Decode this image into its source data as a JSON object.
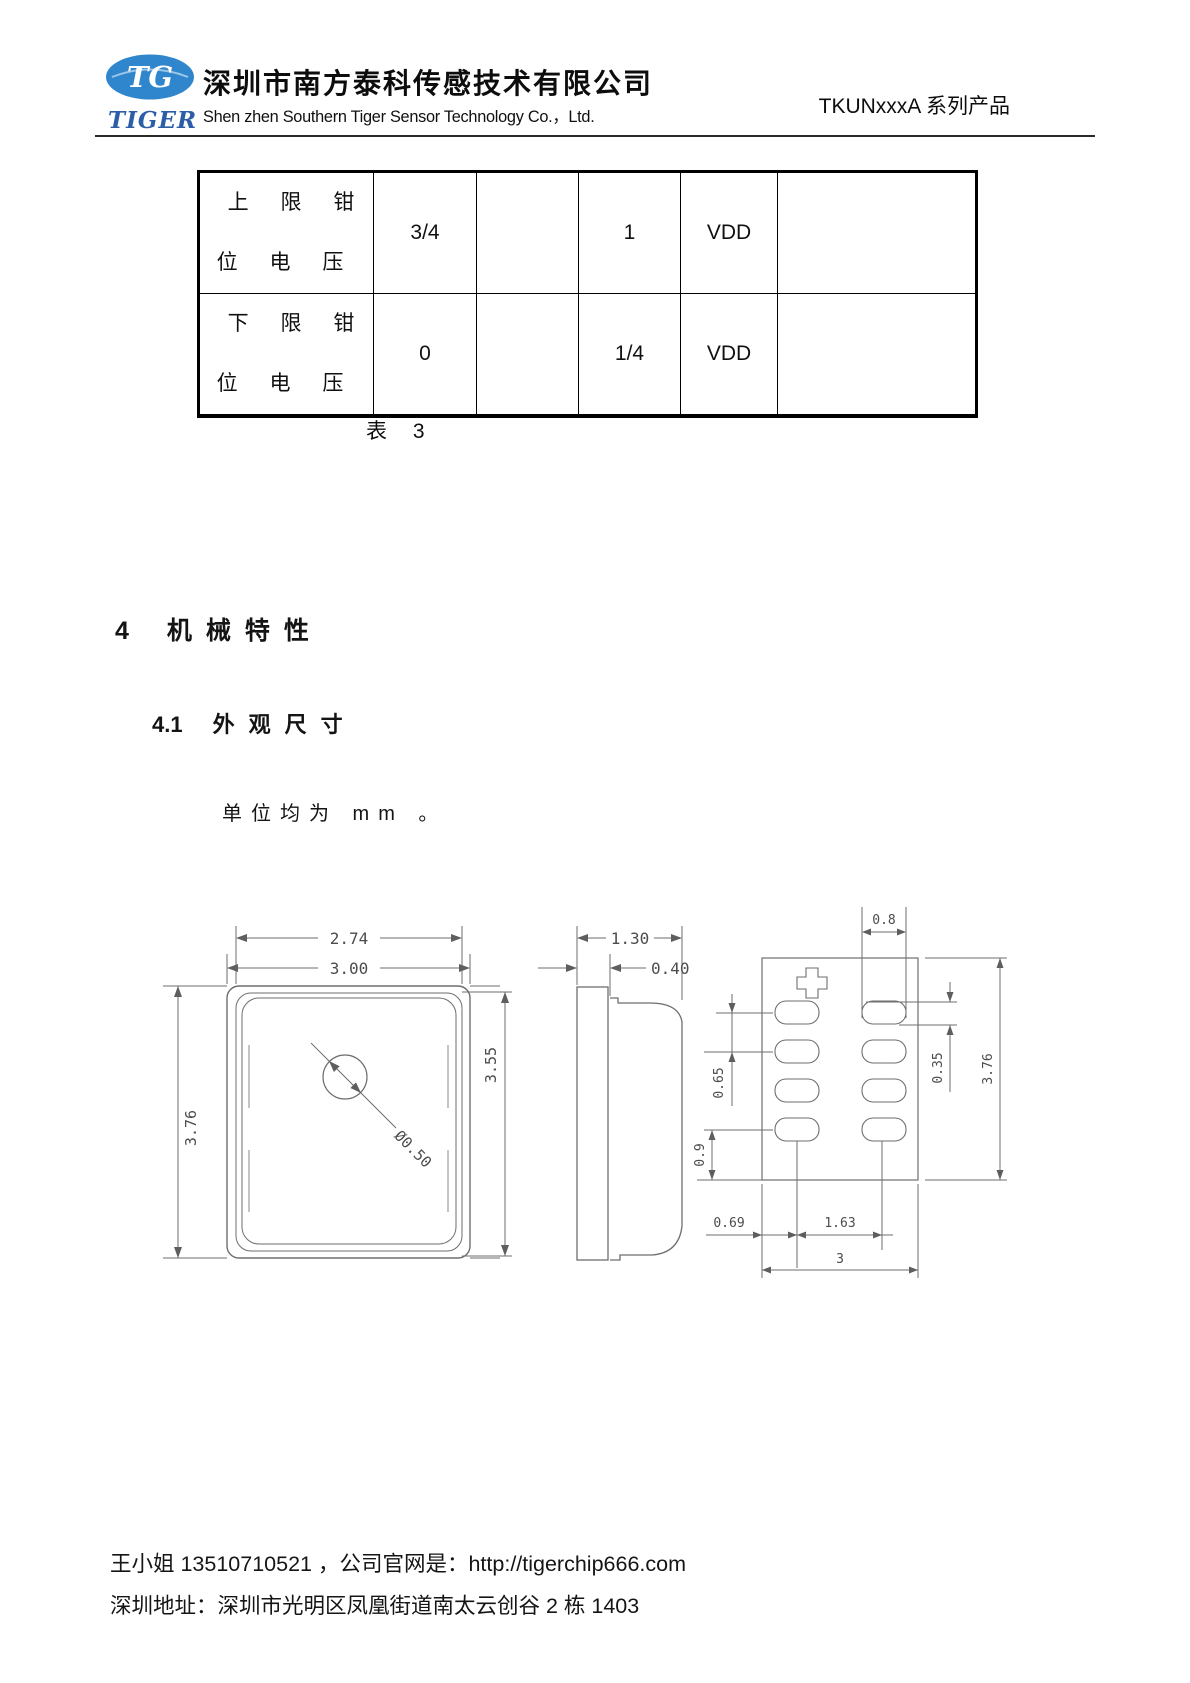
{
  "header": {
    "logo": {
      "tg": "TG",
      "tiger": "TIGER",
      "ellipse_color": "#2f86cc",
      "tiger_color": "#2b5ea7"
    },
    "company_cn": "深圳市南方泰科传感技术有限公司",
    "company_en": "Shen zhen Southern Tiger Sensor Technology Co.，Ltd.",
    "product_series": "TKUNxxxA 系列产品"
  },
  "table": {
    "rows": [
      {
        "label_line1": "上 限 钳",
        "label_line2": "位 电 压",
        "cells": [
          "3/4",
          "",
          "1",
          "VDD",
          ""
        ]
      },
      {
        "label_line1": "下 限 钳",
        "label_line2": "位 电 压",
        "cells": [
          "0",
          "",
          "1/4",
          "VDD",
          ""
        ]
      }
    ],
    "caption": "表 3"
  },
  "sections": {
    "h1_num": "4",
    "h1_title": "机械特性",
    "h2_num": "4.1",
    "h2_title": "外观尺寸",
    "unit_note": "单位均为 mm 。"
  },
  "drawing": {
    "labels": {
      "top_width_inner": "2.74",
      "top_width_outer": "3.00",
      "top_height_left": "3.76",
      "top_height_right": "3.55",
      "top_hole_dia": "Ø0.50",
      "side_width": "1.30",
      "side_lid_thickness": "0.40",
      "bottom_pad_width": "0.8",
      "bottom_pad_pitch": "0.65",
      "bottom_pad_edge_gap": "0.9",
      "bottom_pad_height": "0.35",
      "bottom_height": "3.76",
      "bottom_pad_col_offset": "0.69",
      "bottom_pad_col_span": "1.63",
      "bottom_width": "3"
    }
  },
  "footer": {
    "line1": "王小姐 13510710521 ，公司官网是：http://tigerchip666.com",
    "line2": "深圳地址：深圳市光明区凤凰街道南太云创谷 2 栋 1403"
  }
}
